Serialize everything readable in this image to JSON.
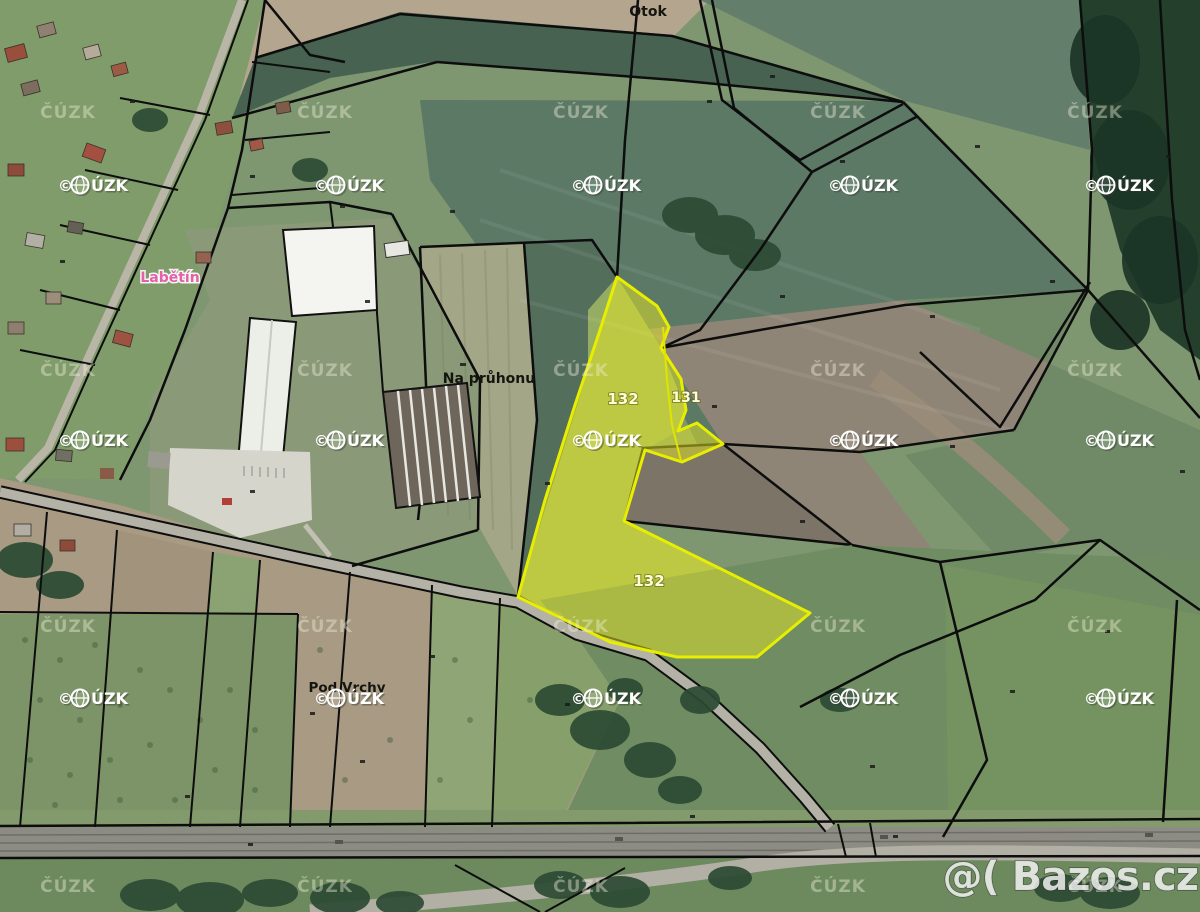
{
  "map": {
    "place_labels": {
      "otok": "Otok",
      "labetin": "Labětín",
      "na_pruhonu": "Na průhonu",
      "pod_vrchy": "Pod Vrchy"
    },
    "parcel_labels": {
      "p132_upper": "132",
      "p132_lower": "132",
      "p131": "131"
    },
    "watermarks": {
      "cuzk": "ČÚZK",
      "cuzk_logo_c": "©",
      "cuzk_logo_uzk": "ÚZK",
      "bazos": "@( Bazos.cz"
    },
    "colors": {
      "highlight_fill": "#e6e623",
      "highlight_stroke": "#e8ee00",
      "boundary_line": "#0d0d0d",
      "label_pink": "#e560a8",
      "parcel_label_fill": "#ffffd6"
    }
  }
}
